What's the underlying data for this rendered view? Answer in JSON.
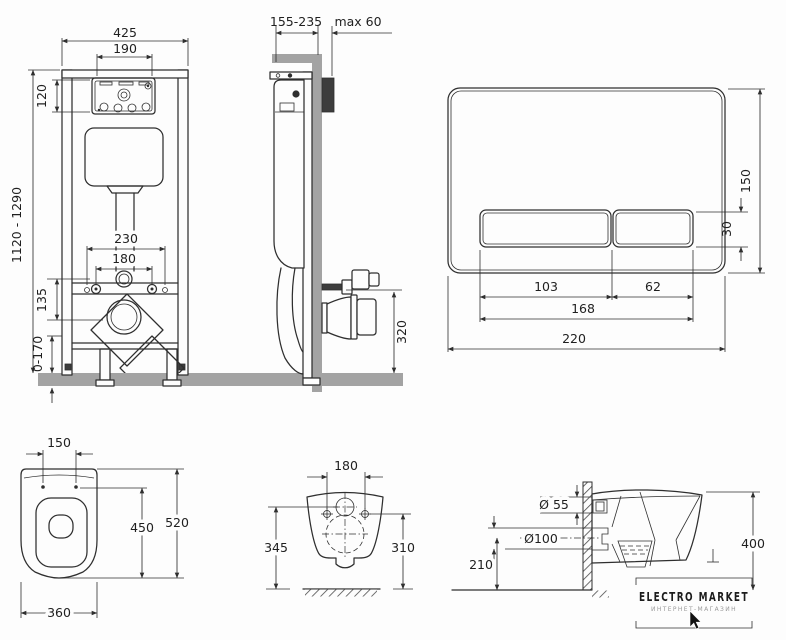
{
  "frame_front": {
    "width": "425",
    "panel_w": "190",
    "panel_h": "120",
    "height": "1120 - 1290",
    "anchors": "230",
    "studs": "180",
    "drain_offset": "135",
    "feet": "0-170"
  },
  "frame_side": {
    "depth": "155-235",
    "max_wall": "max 60",
    "outlet_h": "320"
  },
  "flush_plate": {
    "height": "150",
    "button_h": "30",
    "button_large": "103",
    "button_small": "62",
    "buttons_w": "168",
    "width": "220"
  },
  "bowl_top": {
    "hinge": "150",
    "inner_len": "450",
    "length": "520",
    "width": "360"
  },
  "bowl_back": {
    "holes": "180",
    "inlet_h": "345",
    "holes_h": "310"
  },
  "bowl_side": {
    "inlet_d": "Ø 55",
    "outlet_d": "Ø100",
    "outlet_h": "210",
    "depth": "400"
  },
  "logo": {
    "title": "ELECTRO MARKET",
    "subtitle": "ИНТЕРНЕТ-МАГАЗИН"
  },
  "colors": {
    "line": "#2f2f2f",
    "gray": "#a3a3a3",
    "background": "#fdfdfd"
  }
}
